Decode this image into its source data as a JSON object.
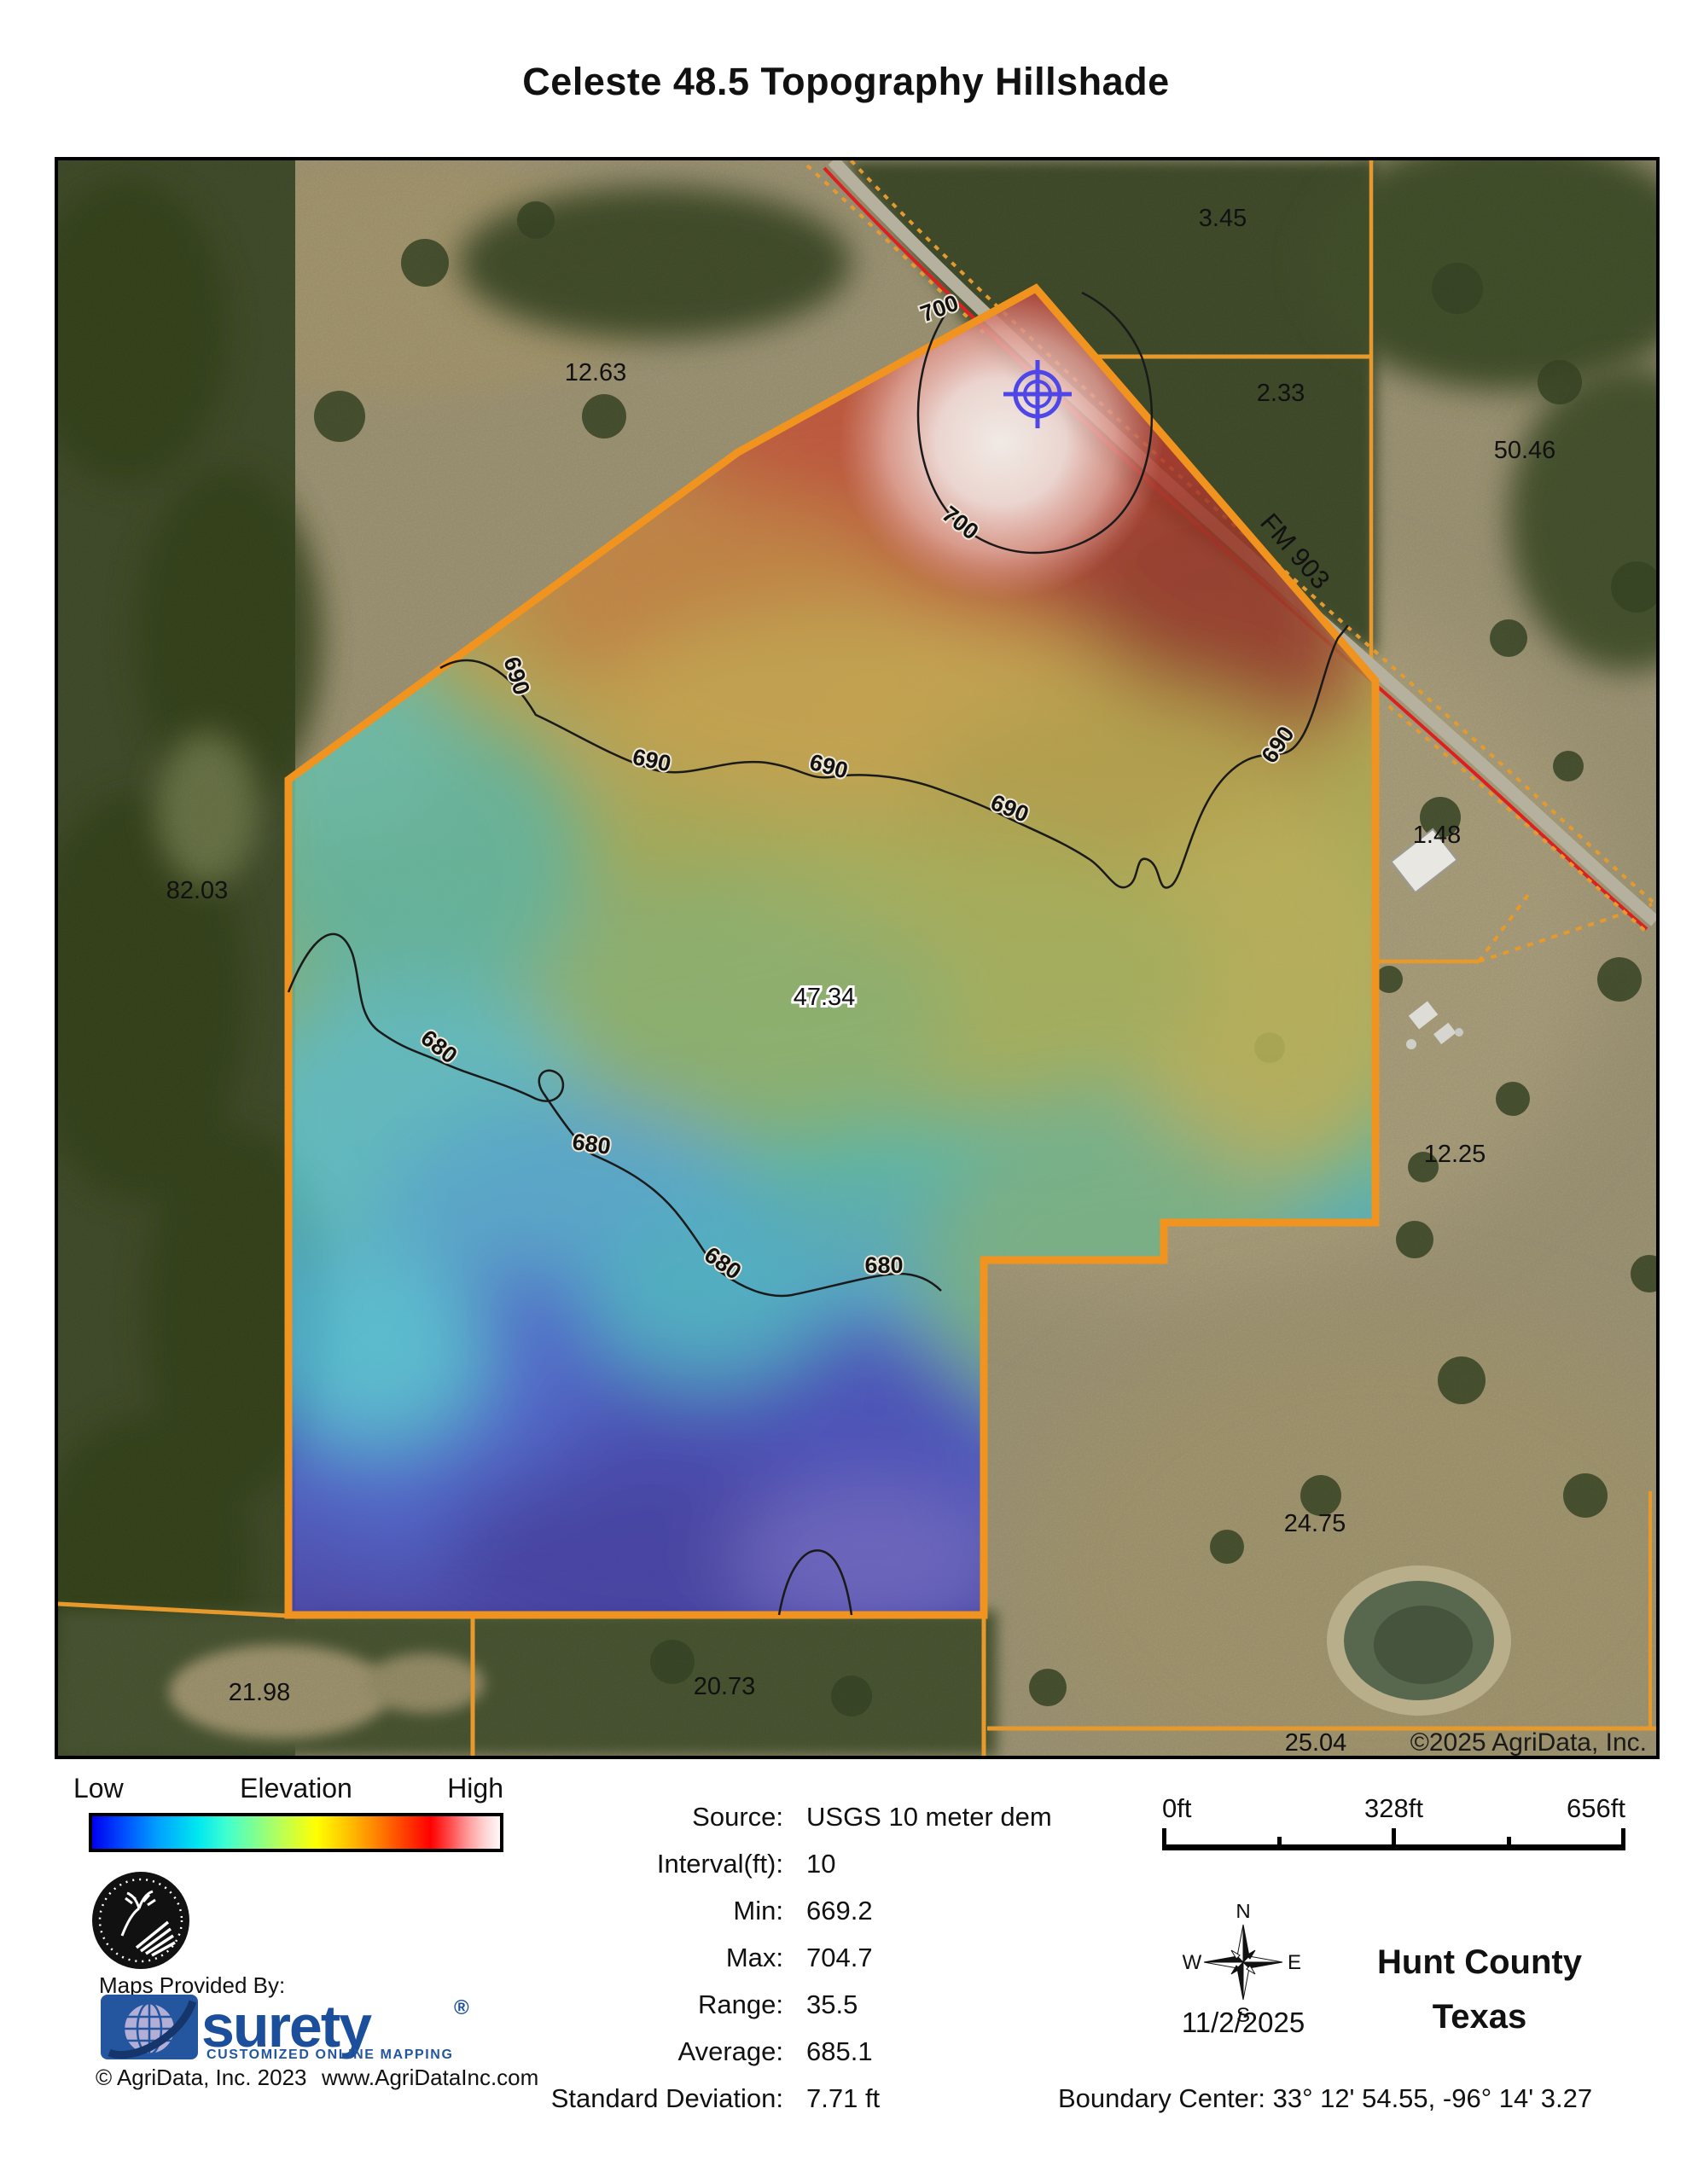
{
  "title": "Celeste 48.5 Topography Hillshade",
  "map": {
    "parcel_labels": [
      "3.45",
      "12.63",
      "2.33",
      "50.46",
      "82.03",
      "1.48",
      "47.34",
      "12.25",
      "24.75",
      "21.98",
      "20.73",
      "25.04"
    ],
    "contours": [
      "680",
      "690",
      "700"
    ],
    "road_label": "FM 903",
    "copyright": "©2025 AgriData, Inc.",
    "colors": {
      "boundary_orange": "#F0941F",
      "road_red": "#DD1F1F",
      "crosshair_blue": "#4F46E8",
      "contour_black": "#1A1A1A"
    }
  },
  "legend": {
    "low": "Low",
    "title": "Elevation",
    "high": "High",
    "ramp": [
      "#0000F0",
      "#00A0FF",
      "#00E8F0",
      "#80FF90",
      "#FFFF00",
      "#FF8000",
      "#FF0000",
      "#FF9898",
      "#FFF8F8"
    ]
  },
  "stats": {
    "rows": [
      {
        "label": "Source:",
        "value": "USGS 10 meter dem"
      },
      {
        "label": "Interval(ft):",
        "value": "10"
      },
      {
        "label": "Min:",
        "value": "669.2"
      },
      {
        "label": "Max:",
        "value": "704.7"
      },
      {
        "label": "Range:",
        "value": "35.5"
      },
      {
        "label": "Average:",
        "value": "685.1"
      },
      {
        "label": "Standard Deviation:",
        "value": "7.71 ft"
      }
    ]
  },
  "provider": {
    "maps_provided_by": "Maps Provided By:",
    "brand": "surety",
    "registered": "®",
    "tagline": "CUSTOMIZED ONLINE MAPPING",
    "brand_blue": "#1B4F9C",
    "copyright": "© AgriData, Inc. 2023",
    "website": "www.AgriDataInc.com"
  },
  "scalebar": {
    "labels": [
      "0ft",
      "328ft",
      "656ft"
    ]
  },
  "compass": {
    "n": "N",
    "s": "S",
    "e": "E",
    "w": "W",
    "date": "11/2/2025"
  },
  "location": {
    "county": "Hunt County",
    "state": "Texas",
    "boundary_center": "Boundary Center: 33° 12' 54.55,  -96° 14' 3.27"
  }
}
